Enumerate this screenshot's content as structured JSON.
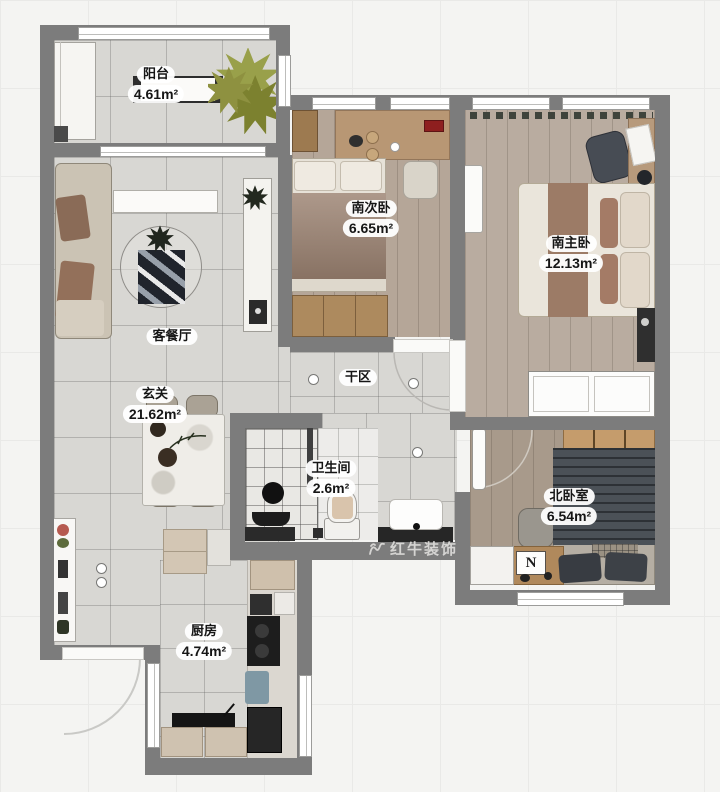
{
  "watermark": {
    "text": "红牛装饰",
    "icon": "bull-logo"
  },
  "rooms": [
    {
      "name": "阳台",
      "area": "4.61m²"
    },
    {
      "name": "客餐厅",
      "area": ""
    },
    {
      "name": "玄关",
      "area": "21.62m²"
    },
    {
      "name": "南次卧",
      "area": "6.65m²"
    },
    {
      "name": "南主卧",
      "area": "12.13m²"
    },
    {
      "name": "干区",
      "area": ""
    },
    {
      "name": "卫生间",
      "area": "2.6m²"
    },
    {
      "name": "北卧室",
      "area": "6.54m²"
    },
    {
      "name": "厨房",
      "area": "4.74m²"
    }
  ],
  "colors": {
    "wall": "#7c7c7c",
    "tile_floor": "#d8d7d3",
    "wood_floor_second": "#b5a698",
    "wood_floor_master": "#b9aca0",
    "wood_floor_north": "#a89a8b",
    "plant_olive": "#8e9140",
    "bed_dark": "#4b5157",
    "bed_brown": "#9b8271"
  }
}
